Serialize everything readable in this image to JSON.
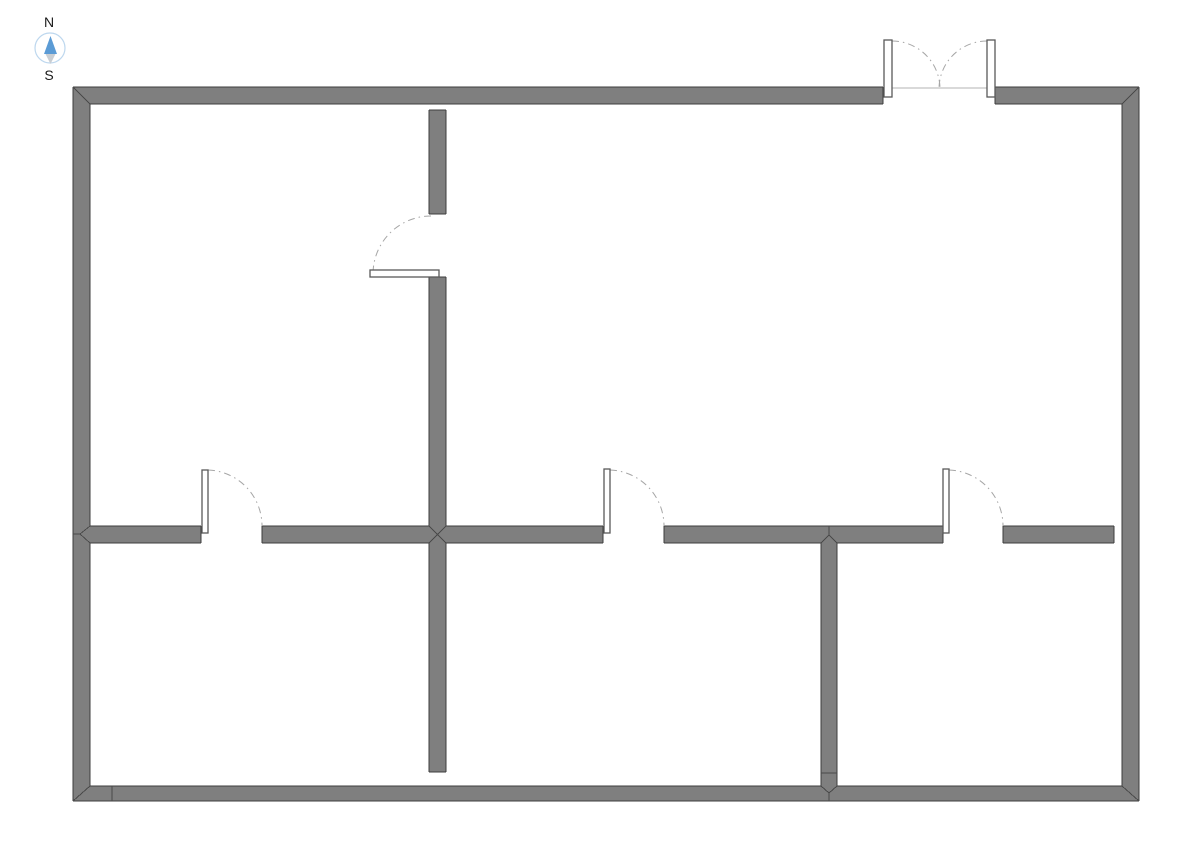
{
  "compass": {
    "north_label": "N",
    "south_label": "S",
    "cx": 50,
    "cy": 48,
    "r": 15,
    "north_needle_points": "50.5,36 44,54 57,54",
    "south_needle_points": "45.5,54 55.5,54 50.5,64",
    "north_label_x": 49,
    "north_label_y": 27,
    "south_label_x": 49,
    "south_label_y": 80
  },
  "colors": {
    "background": "#ffffff",
    "wall_fill": "#7f7f7f",
    "wall_outline": "#3d3d3d",
    "wall_seam": "#4a4a4a",
    "door_swing_arc": "#a6a6a6",
    "door_leaf_fill": "#ffffff",
    "door_leaf_outline": "#595959",
    "threshold_line": "#b3b3b3",
    "compass_ring": "#bdd7ee",
    "compass_north_needle": "#5b9bd5",
    "compass_south_needle": "#c9ced3"
  },
  "plan": {
    "walls": [
      [
        73,
        87,
        810,
        17,
        "outer-wall-top-left-of-entry"
      ],
      [
        995,
        87,
        144,
        17,
        "outer-wall-top-right-of-entry"
      ],
      [
        73,
        87,
        17,
        714,
        "outer-wall-west"
      ],
      [
        1122,
        87,
        17,
        714,
        "outer-wall-east"
      ],
      [
        73,
        786,
        1066,
        15,
        "outer-wall-south"
      ],
      [
        429,
        110,
        17,
        104,
        "interior-wall-vertical-upper-above-door"
      ],
      [
        429,
        277,
        17,
        266,
        "interior-wall-vertical-upper-below-door"
      ],
      [
        429,
        543,
        17,
        229,
        "interior-wall-vertical-middle-lower"
      ],
      [
        90,
        526,
        111,
        17,
        "interior-wall-horizontal-seg1"
      ],
      [
        262,
        526,
        341,
        17,
        "interior-wall-horizontal-seg2"
      ],
      [
        664,
        526,
        279,
        17,
        "interior-wall-horizontal-seg3"
      ],
      [
        1003,
        526,
        111,
        17,
        "interior-wall-horizontal-seg4"
      ],
      [
        821,
        543,
        16,
        243,
        "interior-wall-vertical-east-lower"
      ]
    ],
    "outlines": [
      [
        73,
        87,
        883,
        87
      ],
      [
        995,
        87,
        1139,
        87
      ],
      [
        73,
        87,
        73,
        801
      ],
      [
        1139,
        87,
        1139,
        801
      ],
      [
        73,
        801,
        1139,
        801
      ],
      [
        90,
        104,
        883,
        104
      ],
      [
        995,
        104,
        1122,
        104
      ],
      [
        883,
        87,
        883,
        104
      ],
      [
        995,
        87,
        995,
        104
      ],
      [
        90,
        104,
        90,
        526
      ],
      [
        90,
        543,
        90,
        786
      ],
      [
        1122,
        104,
        1122,
        786
      ],
      [
        90,
        786,
        821,
        786
      ],
      [
        837,
        786,
        1122,
        786
      ],
      [
        429,
        110,
        446,
        110
      ],
      [
        429,
        110,
        429,
        214
      ],
      [
        446,
        110,
        446,
        214
      ],
      [
        429,
        214,
        446,
        214
      ],
      [
        429,
        277,
        446,
        277
      ],
      [
        429,
        277,
        429,
        526
      ],
      [
        446,
        277,
        446,
        526
      ],
      [
        90,
        526,
        201,
        526
      ],
      [
        262,
        526,
        429,
        526
      ],
      [
        446,
        526,
        603,
        526
      ],
      [
        664,
        526,
        943,
        526
      ],
      [
        1003,
        526,
        1114,
        526
      ],
      [
        90,
        543,
        201,
        543
      ],
      [
        262,
        543,
        429,
        543
      ],
      [
        446,
        543,
        603,
        543
      ],
      [
        664,
        543,
        821,
        543
      ],
      [
        837,
        543,
        943,
        543
      ],
      [
        1003,
        543,
        1114,
        543
      ],
      [
        201,
        526,
        201,
        543
      ],
      [
        262,
        526,
        262,
        543
      ],
      [
        603,
        526,
        603,
        543
      ],
      [
        664,
        526,
        664,
        543
      ],
      [
        943,
        526,
        943,
        543
      ],
      [
        1003,
        526,
        1003,
        543
      ],
      [
        1114,
        526,
        1114,
        543
      ],
      [
        429,
        543,
        429,
        772
      ],
      [
        446,
        543,
        446,
        772
      ],
      [
        429,
        772,
        446,
        772
      ],
      [
        821,
        543,
        821,
        786
      ],
      [
        837,
        543,
        837,
        786
      ]
    ],
    "seams": [
      [
        73,
        87,
        90,
        104
      ],
      [
        1139,
        87,
        1122,
        104
      ],
      [
        73,
        801,
        90,
        786
      ],
      [
        1139,
        801,
        1122,
        786
      ],
      [
        112,
        786,
        112,
        801
      ],
      [
        821,
        773,
        837,
        773
      ],
      [
        90,
        526,
        80,
        534
      ],
      [
        90,
        543,
        80,
        534
      ],
      [
        73,
        534,
        80,
        534
      ],
      [
        429,
        526,
        446,
        543
      ],
      [
        446,
        526,
        429,
        543
      ],
      [
        829,
        526,
        829,
        535
      ],
      [
        829,
        535,
        821,
        543
      ],
      [
        829,
        535,
        837,
        543
      ],
      [
        821,
        786,
        829,
        793
      ],
      [
        837,
        786,
        829,
        793
      ],
      [
        829,
        793,
        829,
        801
      ]
    ],
    "threshold": [
      884,
      88,
      994,
      88
    ],
    "door_leaves": [
      [
        884,
        40,
        8,
        57,
        "entry-double-door-left-leaf"
      ],
      [
        987,
        40,
        8,
        57,
        "entry-double-door-right-leaf"
      ],
      [
        370,
        270,
        69,
        7,
        "door-leaf-upper-left-room"
      ],
      [
        202,
        470,
        6,
        63,
        "door-leaf-lower-left-room"
      ],
      [
        604,
        469,
        6,
        64,
        "door-leaf-lower-middle-room"
      ],
      [
        943,
        469,
        6,
        64,
        "door-leaf-lower-right-room"
      ]
    ],
    "door_arcs": [
      [
        "M 892 41 A 48 48 0 0 1 940 89",
        "entry-double-door-left-swing-arc"
      ],
      [
        "M 987 41 A 48 48 0 0 0 939 89",
        "entry-double-door-right-swing-arc"
      ],
      [
        "M 431 216 A 58 58 0 0 0 373 274",
        "door-swing-arc-upper-left-room"
      ],
      [
        "M 208 470 A 56 56 0 0 1 262 526",
        "door-swing-arc-lower-left-room"
      ],
      [
        "M 610 470 A 56 56 0 0 1 664 526",
        "door-swing-arc-lower-middle-room"
      ],
      [
        "M 949 470 A 56 56 0 0 1 1003 526",
        "door-swing-arc-lower-right-room"
      ]
    ]
  }
}
